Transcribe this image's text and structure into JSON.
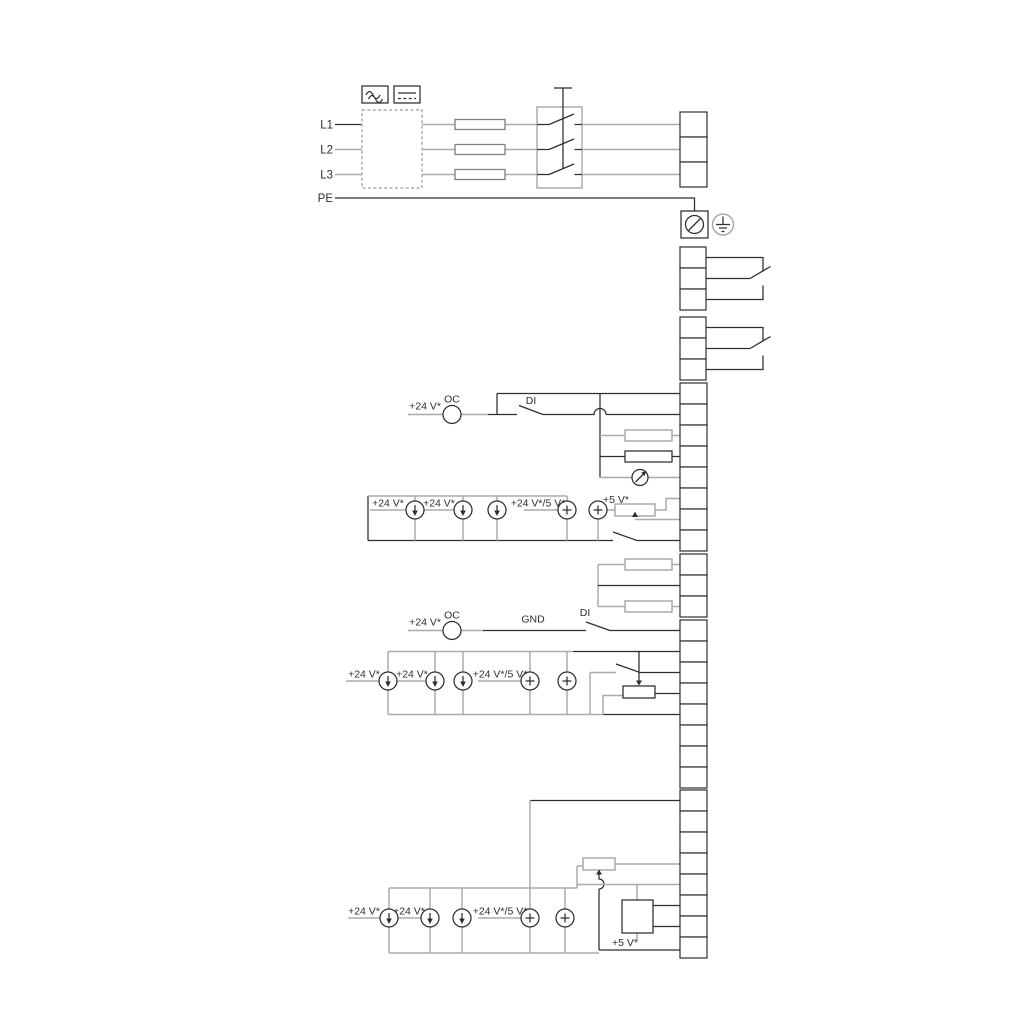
{
  "diagram": {
    "kind": "pump-drive wiring diagram",
    "colors": {
      "line_dark": "#2e2e30",
      "line_gray": "#a9abae",
      "background": "#ffffff"
    },
    "power": {
      "input_labels": [
        "L1",
        "L2",
        "L3"
      ],
      "pe_label": "PE",
      "output_labels": [
        "L1",
        "L2",
        "L3"
      ]
    },
    "relays": {
      "relay1": [
        "NC",
        "C1",
        "NO"
      ],
      "relay2": [
        "NC",
        "C2",
        "NO"
      ]
    },
    "io1": [
      {
        "num": "18",
        "label": "GND"
      },
      {
        "num": "11",
        "label": "DI4/OC2"
      },
      {
        "num": "19",
        "label": "Pt100/1000"
      },
      {
        "num": "17",
        "label": "Pt100/1000"
      },
      {
        "num": "12",
        "label": "AO"
      },
      {
        "num": "9",
        "label": "GND"
      },
      {
        "num": "14",
        "label": "AI3"
      },
      {
        "num": "1",
        "label": "DI2"
      }
    ],
    "liqtec": [
      {
        "num": "21",
        "label": "LiqTec"
      },
      {
        "num": "20",
        "label": "GND"
      },
      {
        "num": "22",
        "label": "LiqTec"
      }
    ],
    "io2": [
      {
        "num": "10",
        "label": "DI3/OC1"
      },
      {
        "num": "4",
        "label": "AI1"
      },
      {
        "num": "2",
        "label": "DI1"
      },
      {
        "num": "5",
        "label": "+5 V"
      },
      {
        "num": "6",
        "label": "GND"
      },
      {
        "num": "A",
        "label": "GENIbus A"
      },
      {
        "num": "Y",
        "label": "GENIbus Y"
      },
      {
        "num": "B",
        "label": "GENIbus B"
      }
    ],
    "io3": [
      {
        "num": "3",
        "label": "GND"
      },
      {
        "num": "15",
        "label": "+24 V"
      },
      {
        "num": "8",
        "label": "+24 V"
      },
      {
        "num": "26",
        "label": "+5 V"
      },
      {
        "num": "23",
        "label": "GND"
      },
      {
        "num": "25",
        "label": "GDS TX"
      },
      {
        "num": "24",
        "label": "GDS RX"
      },
      {
        "num": "7",
        "label": "AI2"
      }
    ],
    "annotations": {
      "oc2_v24": "+24 V*",
      "oc2_oc": "OC",
      "oc2_di": "DI",
      "set1_v24a": "+24 V*",
      "set1_v24b": "+24 V*",
      "set1_mixed": "+24 V*/5 V*",
      "set1_5v": "+5 V*",
      "oc1_v24": "+24 V*",
      "oc1_oc": "OC",
      "oc1_gnd": "GND",
      "oc1_di": "DI",
      "set2_v24a": "+24 V*",
      "set2_v24b": "+24 V*",
      "set2_mixed": "+24 V*/5 V*",
      "set3_v24a": "+24 V*",
      "set3_v24b": "+24 V*",
      "set3_mixed": "+24 V*/5 V*",
      "set3_5v": "+5 V*"
    },
    "icons": [
      "ac-wave-icon",
      "dc-line-icon",
      "screw-terminal-icon",
      "earth-ground-icon",
      "analog-meter-icon"
    ]
  }
}
